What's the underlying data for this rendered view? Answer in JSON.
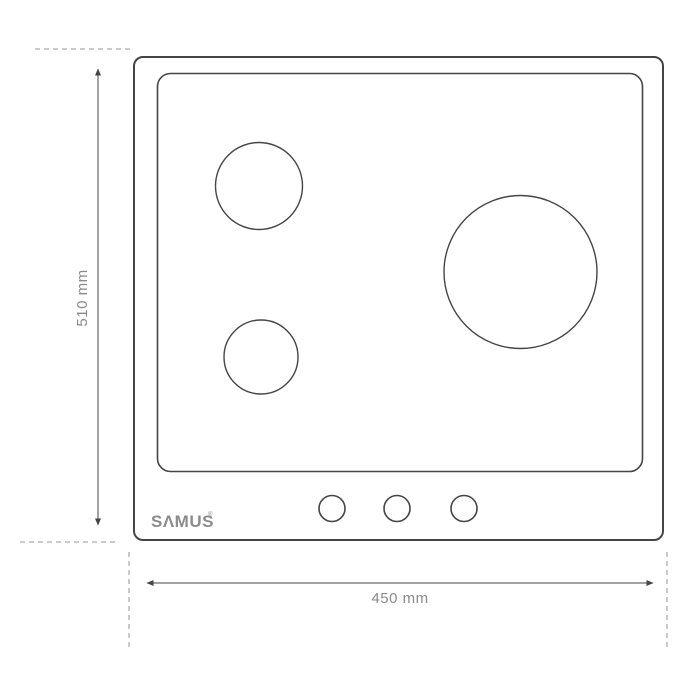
{
  "theme": {
    "background": "#ffffff",
    "line_color": "#454545",
    "dashed_color": "#b8b8b8",
    "dim_text_color": "#8a8a8a",
    "brand_color": "#8c8c8c"
  },
  "diagram": {
    "type": "product-dimension-drawing",
    "subject": "built-in hob top view with three burners and three control knobs",
    "brand": {
      "logo_text": "SΛMUS",
      "registered_mark": "®"
    },
    "dimensions": {
      "height": {
        "label": "510 mm",
        "value": 510,
        "unit": "mm"
      },
      "width": {
        "label": "450 mm",
        "value": 450,
        "unit": "mm"
      }
    },
    "burners": [
      {
        "name": "medium-burner",
        "position": "top-left"
      },
      {
        "name": "small-burner",
        "position": "bottom-left"
      },
      {
        "name": "large-burner",
        "position": "right"
      }
    ],
    "knobs_count": 3
  }
}
